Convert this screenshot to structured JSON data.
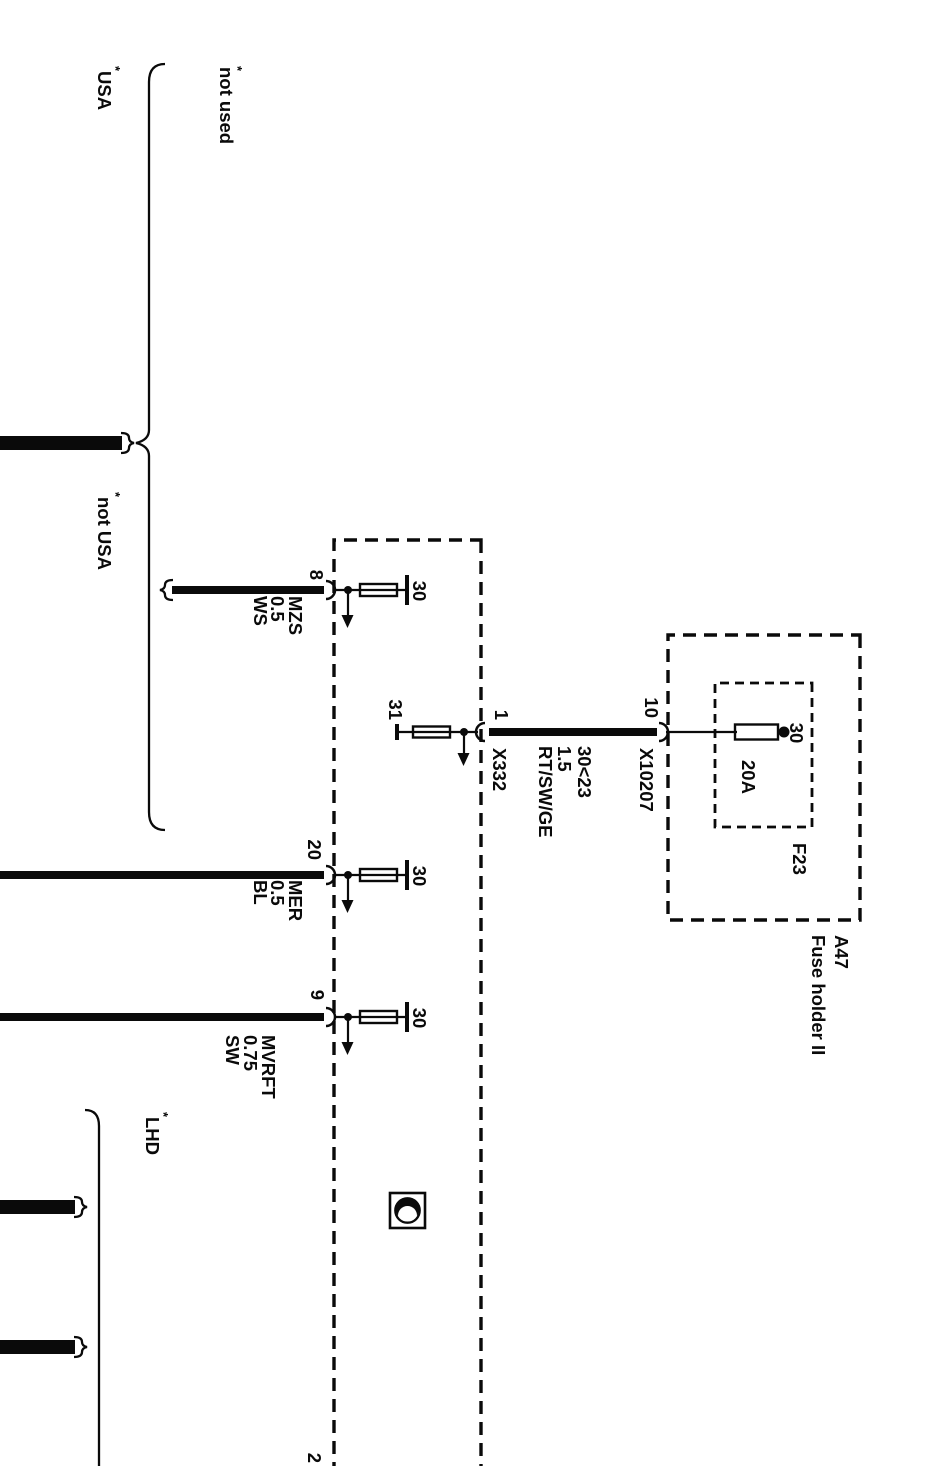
{
  "variants": {
    "footnote_marker": "*",
    "usa": "USA",
    "not_used": "not used",
    "not_usa": "not USA",
    "lhd": "LHD"
  },
  "control_module": {
    "terminal_feeds": [
      {
        "pin": "8",
        "terminal": "30",
        "wire_code": "MZS",
        "wire_size": "0.5",
        "wire_color": "WS"
      },
      {
        "pin": "20",
        "terminal": "30",
        "wire_code": "MER",
        "wire_size": "0.5",
        "wire_color": "BL"
      },
      {
        "pin": "9",
        "terminal": "30",
        "wire_code": "MVRFT",
        "wire_size": "0.75",
        "wire_color": "SW"
      }
    ],
    "ground_feed": {
      "pin": "1",
      "terminal": "31",
      "connector": "X332",
      "track_ref": "30<23",
      "wire_size": "1.5",
      "wire_color": "RT/SW/GE"
    },
    "bottom_pin": "2"
  },
  "fuse_holder": {
    "designation": "A47",
    "title": "Fuse holder II",
    "pin": "10",
    "connector": "X10207",
    "fuse_id": "F23",
    "fuse_rating": "20A",
    "terminal": "30"
  },
  "colors": {
    "box_fill": "#dbdbdb",
    "ink": "#0a0a0a",
    "paper": "#ffffff"
  }
}
